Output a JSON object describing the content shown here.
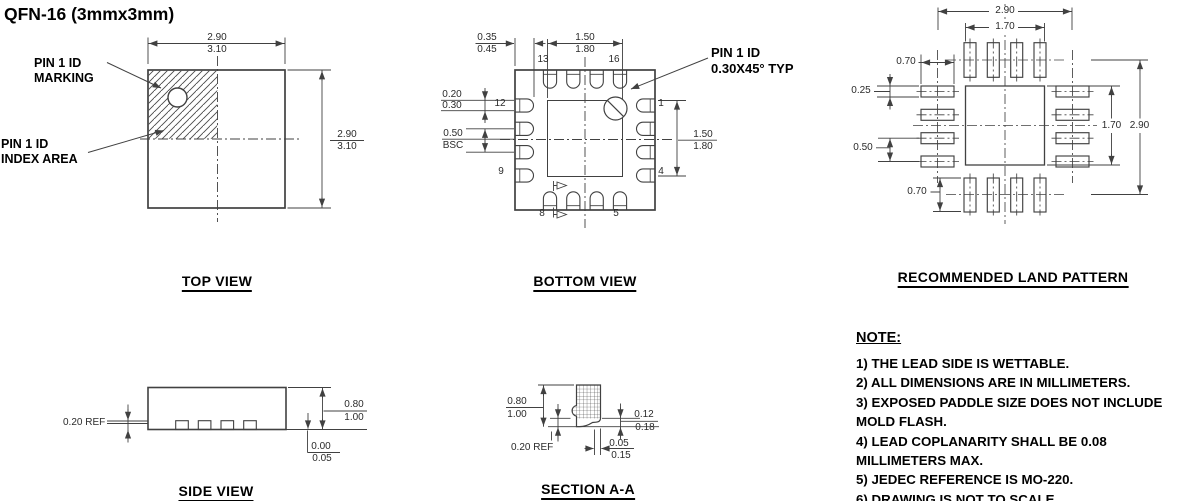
{
  "title": "QFN-16 (3mmx3mm)",
  "top_view": {
    "label": "TOP VIEW",
    "marking_callout": [
      "PIN 1 ID",
      "MARKING"
    ],
    "index_callout": [
      "PIN 1 ID",
      "INDEX AREA"
    ],
    "width_dim": {
      "top": "2.90",
      "bottom": "3.10"
    },
    "height_dim": {
      "top": "2.90",
      "bottom": "3.10"
    }
  },
  "bottom_view": {
    "label": "BOTTOM VIEW",
    "pin1_callout": [
      "PIN 1 ID",
      "0.30X45° TYP"
    ],
    "lead_width_dim": {
      "top": "0.35",
      "bottom": "0.45"
    },
    "paddle_width_dim": {
      "top": "1.50",
      "bottom": "1.80"
    },
    "pad_width_dim": {
      "top": "0.20",
      "bottom": "0.30"
    },
    "pitch_dim": {
      "top": "0.50",
      "bottom": "BSC"
    },
    "paddle_height_dim": {
      "top": "1.50",
      "bottom": "1.80"
    },
    "pins": {
      "p13": "13",
      "p16": "16",
      "p12": "12",
      "p1": "1",
      "p9": "9",
      "p4": "4",
      "p8": "8",
      "p5": "5"
    }
  },
  "land_pattern": {
    "label": "RECOMMENDED LAND PATTERN",
    "dims": {
      "outer_width": "2.90",
      "paddle_width": "1.70",
      "pad_length_left": "0.70",
      "pad_width": "0.25",
      "pitch": "0.50",
      "pad_length_bottom": "0.70",
      "paddle_height": "1.70",
      "outer_height": "2.90"
    }
  },
  "side_view": {
    "label": "SIDE VIEW",
    "lead_thickness_dim": "0.20  REF",
    "height_dim": {
      "top": "0.80",
      "bottom": "1.00"
    },
    "standoff_dim": {
      "top": "0.00",
      "bottom": "0.05"
    }
  },
  "section_view": {
    "label": "SECTION A-A",
    "height_dim": {
      "top": "0.80",
      "bottom": "1.00"
    },
    "lead_tip_dim": {
      "top": "0.12",
      "bottom": "0.18"
    },
    "foot_length_dim": {
      "top": "0.05",
      "bottom": "0.15"
    },
    "lead_thickness_dim": "0.20  REF"
  },
  "notes": {
    "heading": "NOTE:",
    "items": [
      "1) THE LEAD SIDE IS WETTABLE.",
      "2) ALL DIMENSIONS ARE IN MILLIMETERS.",
      "3) EXPOSED PADDLE SIZE DOES NOT INCLUDE MOLD FLASH.",
      "4) LEAD COPLANARITY SHALL BE 0.08 MILLIMETERS MAX.",
      "5) JEDEC REFERENCE IS MO-220.",
      "6) DRAWING IS NOT TO SCALE."
    ]
  },
  "colors": {
    "line": "#414141",
    "text": "#000000",
    "background": "#ffffff"
  }
}
